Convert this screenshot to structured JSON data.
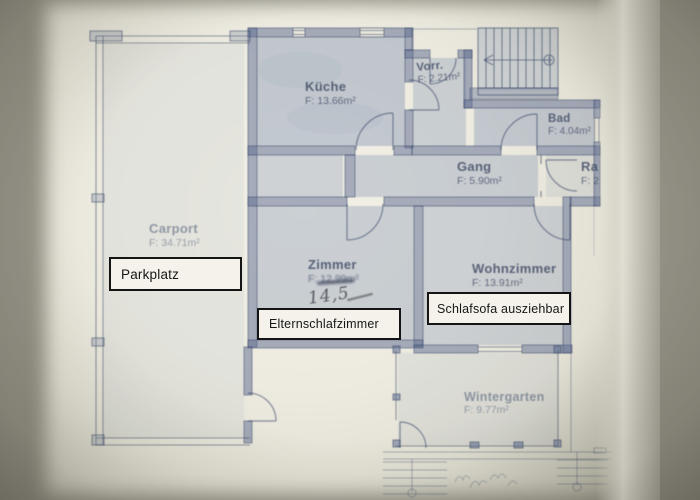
{
  "rooms": {
    "kueche": {
      "name": "Küche",
      "area": "F: 13.66m²"
    },
    "vorr": {
      "name": "Vorr.",
      "area": "F: 2.21m²"
    },
    "bad": {
      "name": "Bad",
      "area": "F: 4.04m²"
    },
    "gang": {
      "name": "Gang",
      "area": "F: 5.90m²"
    },
    "ra": {
      "name": "Ra",
      "area": "F: 2"
    },
    "carport": {
      "name": "Carport",
      "area": "F: 34.71m²"
    },
    "zimmer": {
      "name": "Zimmer",
      "area": "F: 12,99m²",
      "handwritten": "14,5"
    },
    "wohnzimmer": {
      "name": "Wohnzimmer",
      "area": "F: 13.91m²"
    },
    "wintergarten": {
      "name": "Wintergarten",
      "area": "F: 9.77m²"
    }
  },
  "annotations": {
    "parkplatz": "Parkplatz",
    "elternschlafzimmer": "Elternschlafzimmer",
    "schlafsofa": "Schlafsofa ausziehbar"
  },
  "icons": {
    "stairs_direction": "stair-run arrow from circle, pointing left"
  },
  "colors": {
    "photo_background": "#98968a",
    "paper": "#efece1",
    "room_fill": "#8fa3c0",
    "wall": "#5f6e91",
    "plan_ink": "#3c4763",
    "annotation_border": "#141414",
    "annotation_bg": "#f4f2ea",
    "handwriting": "#4a4a50"
  }
}
